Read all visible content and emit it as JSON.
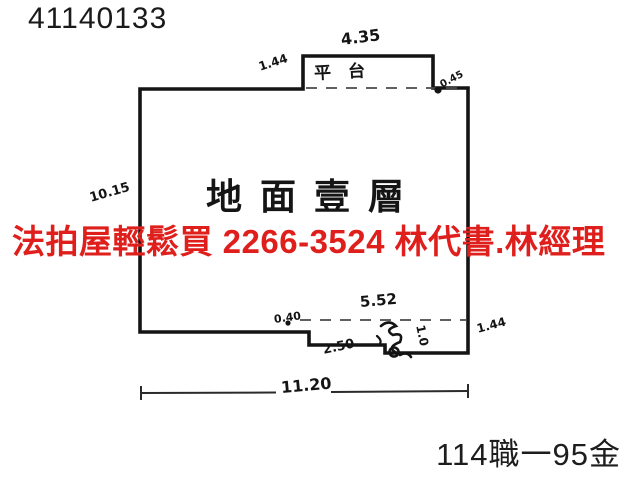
{
  "header": {
    "doc_number": "41140133"
  },
  "floor_plan": {
    "room_label": "地面壹層",
    "platform_label": "平台",
    "ink_color": "#141414",
    "dimensions": {
      "top_width": "4.35",
      "top_left_setback": "1.44",
      "top_right_step": "0.45",
      "left_height": "10.15",
      "bottom_inner_width": "5.52",
      "bottom_left_offset": "0.40",
      "bottom_step_width": "2.50",
      "bottom_step_depth": "1.0",
      "right_bottom_setback": "1.44",
      "overall_width": "11.20"
    }
  },
  "watermark": {
    "text": "法拍屋輕鬆買  2266-3524  林代書.林經理",
    "color": "#df1f1c"
  },
  "footer": {
    "case_number": "114職一95金"
  }
}
